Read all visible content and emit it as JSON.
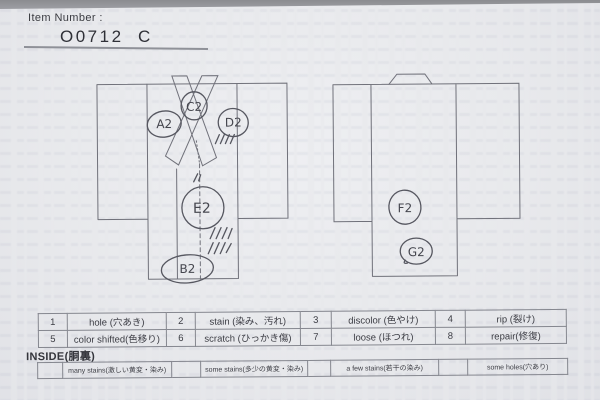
{
  "header": {
    "item_number_label": "Item Number :",
    "item_number_value": "O0712  C"
  },
  "diagrams": {
    "front": {
      "name": "kimono front view",
      "markers": [
        {
          "id": "A2",
          "label": "A2"
        },
        {
          "id": "C2",
          "label": "C2"
        },
        {
          "id": "D2",
          "label": "D2"
        },
        {
          "id": "E2",
          "label": "E2"
        },
        {
          "id": "B2",
          "label": "B2"
        }
      ]
    },
    "back": {
      "name": "kimono back view",
      "markers": [
        {
          "id": "F2",
          "label": "F2"
        },
        {
          "id": "G2",
          "label": "G2"
        }
      ]
    }
  },
  "defect_table": {
    "items": [
      {
        "code": "1",
        "label": "hole (穴あき)"
      },
      {
        "code": "2",
        "label": "stain (染み、汚れ)"
      },
      {
        "code": "3",
        "label": "discolor (色やけ)"
      },
      {
        "code": "4",
        "label": "rip (裂け)"
      },
      {
        "code": "5",
        "label": "color shifted(色移り)"
      },
      {
        "code": "6",
        "label": "scratch (ひっかき傷)"
      },
      {
        "code": "7",
        "label": "loose (ほつれ)"
      },
      {
        "code": "8",
        "label": "repair(修復)"
      }
    ]
  },
  "inside_section": {
    "title": "INSIDE(胴裏)",
    "options": [
      {
        "label": "many stains(激しい黄変・染み)"
      },
      {
        "label": "some stains(多少の黄変・染み)"
      },
      {
        "label": "a few stains(若干の染み)"
      },
      {
        "label": "some holes(穴あり)"
      }
    ]
  },
  "colors": {
    "paper": "#e8e9ec",
    "line": "#70717a",
    "pencil": "#565760",
    "text": "#3c3d44"
  }
}
